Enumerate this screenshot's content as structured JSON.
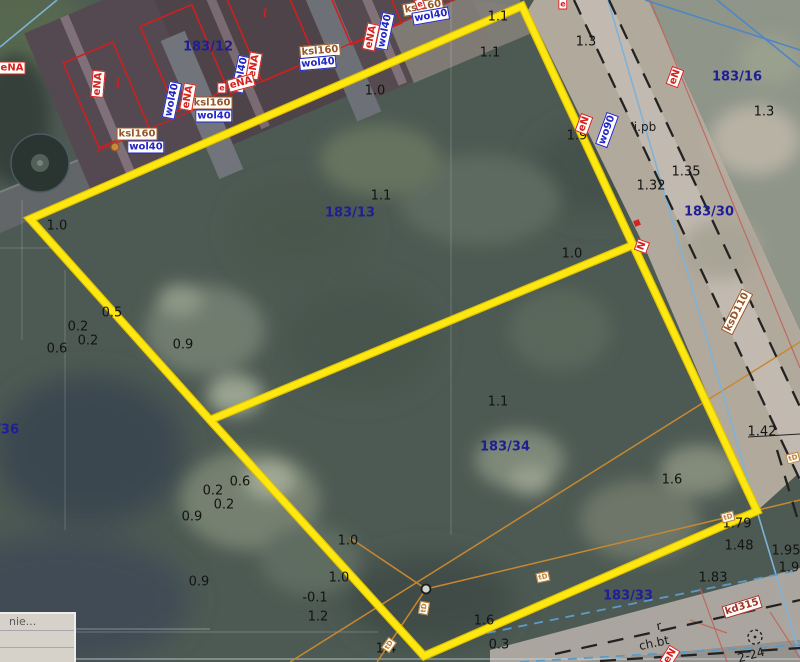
{
  "map": {
    "parcel_labels": [
      {
        "text": "183/12",
        "x": 208,
        "y": 47
      },
      {
        "text": "183/13",
        "x": 350,
        "y": 213
      },
      {
        "text": "183/16",
        "x": 737,
        "y": 77
      },
      {
        "text": "183/30",
        "x": 709,
        "y": 212
      },
      {
        "text": "183/33",
        "x": 628,
        "y": 596
      },
      {
        "text": "183/34",
        "x": 505,
        "y": 447
      },
      {
        "text": "183/36",
        "x": -6,
        "y": 430
      }
    ],
    "elevation_labels": [
      {
        "text": "1.0",
        "x": 57,
        "y": 226
      },
      {
        "text": "1.0",
        "x": 375,
        "y": 91
      },
      {
        "text": "1.1",
        "x": 498,
        "y": 17
      },
      {
        "text": "1.1",
        "x": 490,
        "y": 53
      },
      {
        "text": "1.1",
        "x": 381,
        "y": 196
      },
      {
        "text": "1.3",
        "x": 586,
        "y": 42
      },
      {
        "text": "1.3",
        "x": 764,
        "y": 112
      },
      {
        "text": "1.9",
        "x": 577,
        "y": 136
      },
      {
        "text": "1.35",
        "x": 686,
        "y": 172
      },
      {
        "text": "1.32",
        "x": 651,
        "y": 186
      },
      {
        "text": "1.0",
        "x": 572,
        "y": 254
      },
      {
        "text": "0.5",
        "x": 112,
        "y": 313
      },
      {
        "text": "0.2",
        "x": 78,
        "y": 327
      },
      {
        "text": "0.2",
        "x": 88,
        "y": 341
      },
      {
        "text": "0.6",
        "x": 57,
        "y": 349
      },
      {
        "text": "0.9",
        "x": 183,
        "y": 345
      },
      {
        "text": "1.1",
        "x": 498,
        "y": 402
      },
      {
        "text": "1.6",
        "x": 672,
        "y": 480
      },
      {
        "text": "1.42",
        "x": 762,
        "y": 432
      },
      {
        "text": "0.6",
        "x": 240,
        "y": 482
      },
      {
        "text": "0.2",
        "x": 213,
        "y": 491
      },
      {
        "text": "0.2",
        "x": 224,
        "y": 505
      },
      {
        "text": "0.9",
        "x": 192,
        "y": 517
      },
      {
        "text": "0.9",
        "x": 199,
        "y": 582
      },
      {
        "text": "1.0",
        "x": 348,
        "y": 541
      },
      {
        "text": "1.0",
        "x": 339,
        "y": 578
      },
      {
        "text": "-0.1",
        "x": 315,
        "y": 598
      },
      {
        "text": "1.2",
        "x": 318,
        "y": 617
      },
      {
        "text": "1.4",
        "x": 386,
        "y": 649
      },
      {
        "text": "1.6",
        "x": 484,
        "y": 621
      },
      {
        "text": "0.3",
        "x": 499,
        "y": 645
      },
      {
        "text": "1.79",
        "x": 737,
        "y": 524
      },
      {
        "text": "1.48",
        "x": 739,
        "y": 546
      },
      {
        "text": "1.95",
        "x": 786,
        "y": 551
      },
      {
        "text": "1.9",
        "x": 789,
        "y": 568
      },
      {
        "text": "1.83",
        "x": 713,
        "y": 578
      }
    ],
    "surface_labels": [
      {
        "text": "i.pb",
        "x": 645,
        "y": 127,
        "rot": 0,
        "kind": "surface"
      },
      {
        "text": "r",
        "x": 659,
        "y": 626,
        "rot": -12,
        "kind": "surface"
      },
      {
        "text": "ch.bt",
        "x": 654,
        "y": 643,
        "rot": -12,
        "kind": "surface"
      },
      {
        "text": "2-24",
        "x": 751,
        "y": 655,
        "rot": -15,
        "kind": "surface"
      },
      {
        "text": "i",
        "x": 118,
        "y": 83,
        "rot": 0,
        "kind": "bmark"
      },
      {
        "text": "i",
        "x": 265,
        "y": 13,
        "rot": 0,
        "kind": "bmark"
      }
    ],
    "utility_labels": [
      {
        "text": "ksl160",
        "x": 137,
        "y": 134,
        "rot": 0,
        "kind": "sewer"
      },
      {
        "text": "wol40",
        "x": 146,
        "y": 147,
        "rot": 0,
        "kind": "water"
      },
      {
        "text": "ksl160",
        "x": 212,
        "y": 103,
        "rot": 0,
        "kind": "sewer"
      },
      {
        "text": "wol40",
        "x": 214,
        "y": 116,
        "rot": 0,
        "kind": "water"
      },
      {
        "text": "ksl160",
        "x": 320,
        "y": 51,
        "rot": -5,
        "kind": "sewer"
      },
      {
        "text": "wol40",
        "x": 318,
        "y": 63,
        "rot": -5,
        "kind": "water"
      },
      {
        "text": "ksl160",
        "x": 423,
        "y": 7,
        "rot": -10,
        "kind": "sewer"
      },
      {
        "text": "wol40",
        "x": 431,
        "y": 16,
        "rot": -10,
        "kind": "water"
      },
      {
        "text": "wol40",
        "x": 172,
        "y": 100,
        "rot": -78,
        "kind": "water"
      },
      {
        "text": "eNA",
        "x": 188,
        "y": 97,
        "rot": -80,
        "kind": "power"
      },
      {
        "text": "wol40",
        "x": 241,
        "y": 74,
        "rot": -78,
        "kind": "water"
      },
      {
        "text": "eNA",
        "x": 254,
        "y": 66,
        "rot": -80,
        "kind": "power"
      },
      {
        "text": "wol40",
        "x": 385,
        "y": 31,
        "rot": -78,
        "kind": "water"
      },
      {
        "text": "eNA",
        "x": 371,
        "y": 37,
        "rot": -78,
        "kind": "power"
      },
      {
        "text": "eNA",
        "x": 98,
        "y": 84,
        "rot": -85,
        "kind": "power"
      },
      {
        "text": "eNA",
        "x": 241,
        "y": 83,
        "rot": -15,
        "kind": "power"
      },
      {
        "text": "eNA",
        "x": 12,
        "y": 68,
        "rot": 0,
        "kind": "power"
      },
      {
        "text": "eN",
        "x": 675,
        "y": 77,
        "rot": -70,
        "kind": "power"
      },
      {
        "text": "eN",
        "x": 584,
        "y": 124,
        "rot": -70,
        "kind": "power"
      },
      {
        "text": "wo90",
        "x": 607,
        "y": 130,
        "rot": -70,
        "kind": "water"
      },
      {
        "text": "N",
        "x": 642,
        "y": 246,
        "rot": -70,
        "kind": "power"
      },
      {
        "text": "ksD110",
        "x": 737,
        "y": 312,
        "rot": -63,
        "kind": "sewer"
      },
      {
        "text": "kd315",
        "x": 742,
        "y": 607,
        "rot": -17,
        "kind": "storm"
      },
      {
        "text": "eN",
        "x": 670,
        "y": 656,
        "rot": -58,
        "kind": "power"
      }
    ],
    "marker_labels": [
      {
        "text": "tD",
        "x": 424,
        "y": 608,
        "rot": -80,
        "kind": "t"
      },
      {
        "text": "tD",
        "x": 543,
        "y": 577,
        "rot": -12,
        "kind": "t"
      },
      {
        "text": "tD",
        "x": 389,
        "y": 645,
        "rot": -55,
        "kind": "t"
      },
      {
        "text": "tD",
        "x": 728,
        "y": 517,
        "rot": -15,
        "kind": "t"
      },
      {
        "text": "tD",
        "x": 793,
        "y": 458,
        "rot": -15,
        "kind": "t"
      },
      {
        "text": "e",
        "x": 563,
        "y": 4,
        "rot": 0,
        "kind": "e"
      },
      {
        "text": "e",
        "x": 420,
        "y": 4,
        "rot": -20,
        "kind": "e"
      },
      {
        "text": "e",
        "x": 222,
        "y": 88,
        "rot": 0,
        "kind": "e"
      }
    ]
  },
  "panel": {
    "truncated_text": "nie..."
  },
  "colors": {
    "boundary_yellow": "#ffe711",
    "parcel_number_blue": "#1e1e96",
    "water_label_blue": "#2026c8",
    "sewer_label_brown": "#96562a",
    "power_label_red": "#d42222",
    "storm_label_darkred": "#a03028",
    "building_outline_red": "#cf1f1f"
  }
}
